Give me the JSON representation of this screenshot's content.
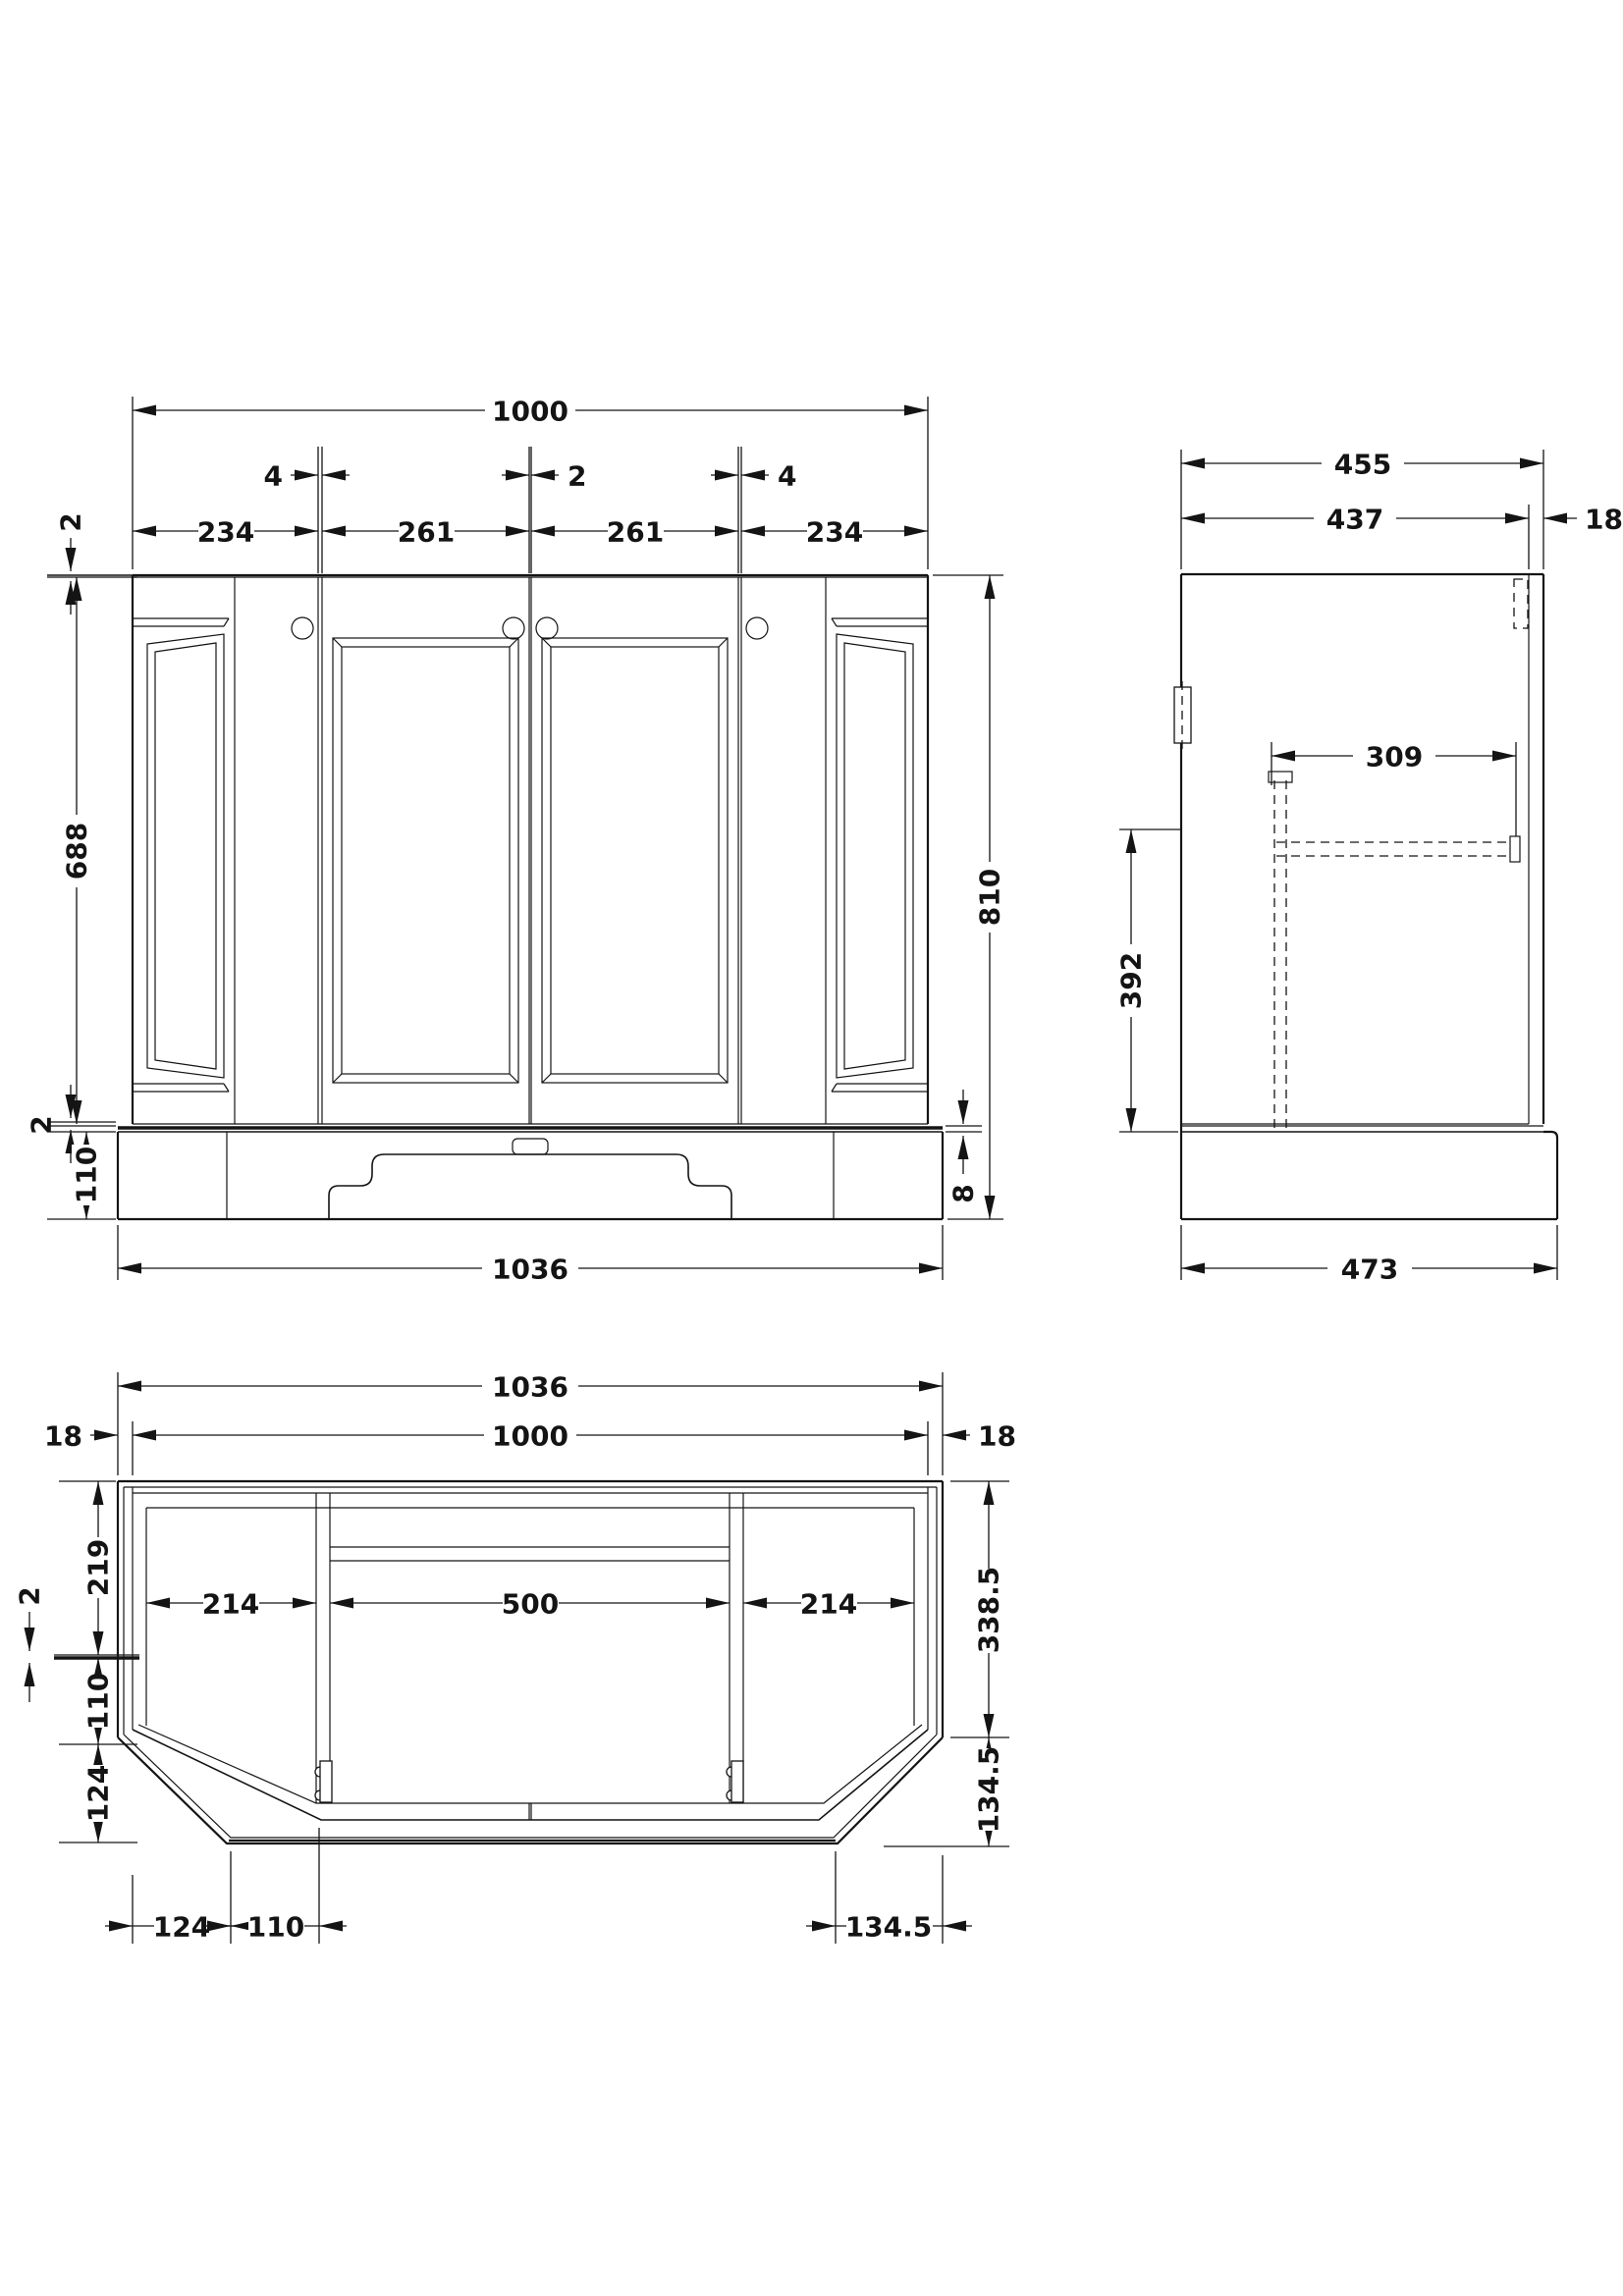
{
  "front": {
    "overall_width": "1000",
    "gap_a": "4",
    "gap_b": "2",
    "gap_c": "4",
    "door_1": "234",
    "door_2": "261",
    "door_3": "261",
    "door_4": "234",
    "top_clearance": "2",
    "door_height": "688",
    "bottom_clearance": "2",
    "plinth_height": "110",
    "overall_height": "810",
    "worktop_gap": "8",
    "base_width": "1036"
  },
  "side": {
    "overall_depth": "455",
    "carcass_depth": "437",
    "door_thickness": "18",
    "opening_width": "309",
    "clearance_height": "392",
    "base_depth": "473"
  },
  "plan": {
    "base_width": "1036",
    "body_width": "1000",
    "overhang_left": "18",
    "overhang_right": "18",
    "bay_left": "214",
    "bay_centre": "500",
    "bay_right": "214",
    "back_section": "219",
    "panel_gap": "2",
    "side_section": "110",
    "chamfer_section": "124",
    "straight_depth": "338.5",
    "chamfer_depth": "134.5",
    "chamfer_run_left": "124",
    "front_run_left": "110",
    "chamfer_run_right": "134.5"
  }
}
